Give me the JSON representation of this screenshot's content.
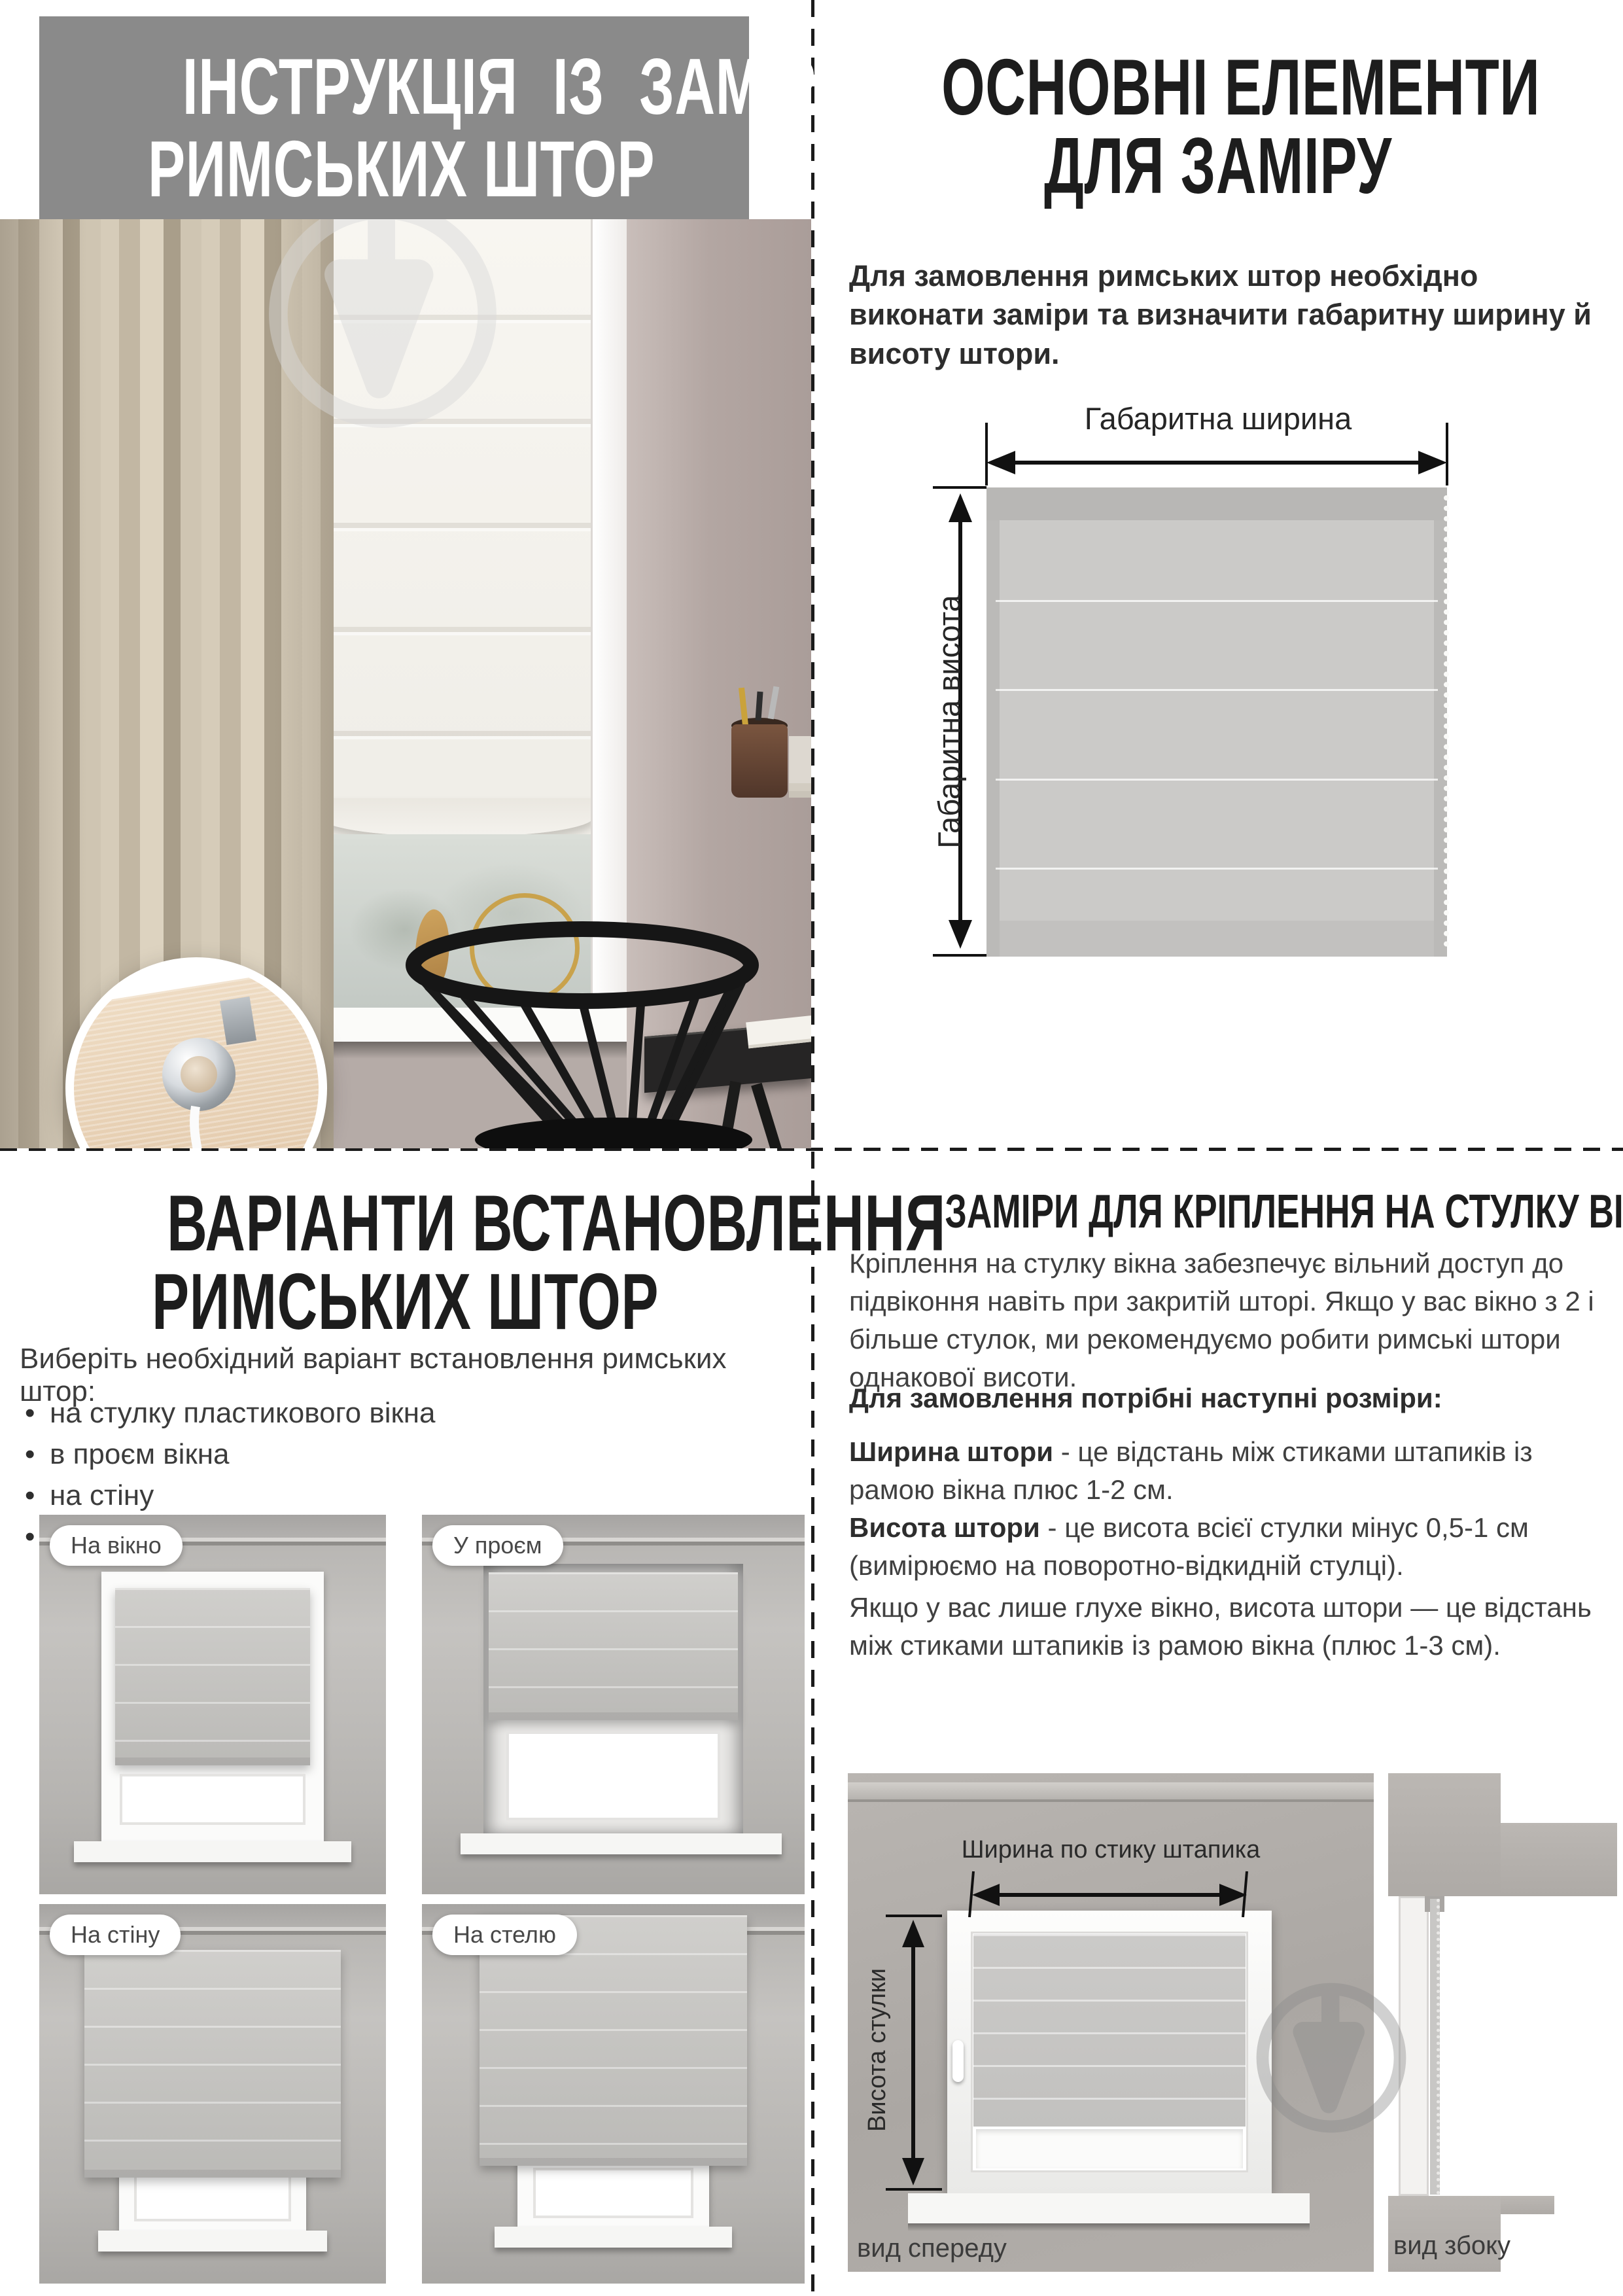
{
  "colors": {
    "header_bg": "#8a8a8a",
    "heading_text": "#1d1d1d",
    "divider": "#1b1b1b",
    "fabric_gray": "#cbcac8",
    "wall_mauve": "#b3a6a2"
  },
  "top_left": {
    "title_line1": "ІНСТРУКЦІЯ ІЗ ЗАМІРУ",
    "title_line2": "РИМСЬКИХ ШТОР"
  },
  "top_right": {
    "title_line1": "ОСНОВНІ ЕЛЕМЕНТИ",
    "title_line2": "ДЛЯ ЗАМІРУ",
    "intro": "Для замовлення римських штор необхідно виконати заміри та визначити габаритну ширину й висоту штори.",
    "diagram": {
      "width_label": "Габаритна ширина",
      "height_label": "Габаритна висота"
    }
  },
  "bottom_left": {
    "title_line1": "ВАРІАНТИ ВСТАНОВЛЕННЯ",
    "title_line2": "РИМСЬКИХ ШТОР",
    "intro": "Виберіть необхідний варіант встановлення римських штор:",
    "options": [
      "на стулку пластикового вікна",
      "в проєм вікна",
      "на стіну",
      "на стелю"
    ],
    "tiles": [
      {
        "label": "На вікно"
      },
      {
        "label": "У проєм"
      },
      {
        "label": "На стіну"
      },
      {
        "label": "На стелю"
      }
    ]
  },
  "bottom_right": {
    "title": "ЗАМІРИ ДЛЯ КРІПЛЕННЯ НА СТУЛКУ ВІКНА",
    "p1": "Кріплення на стулку вікна забезпечує вільний доступ до підвіконня навіть при закритій шторі. Якщо у вас вікно з 2 і більше стулок, ми рекомендуємо робити римські штори однакової висоти.",
    "sizes_lead": "Для замовлення потрібні наступні розміри:",
    "width_term": "Ширина штори",
    "width_def": " - це відстань між стиками штапиків із рамою вікна плюс 1-2 см.",
    "height_term": "Висота штори",
    "height_def": " - це висота всієї стулки мінус 0,5-1 см (вимірюємо на поворотно-відкидній стулці).",
    "p3": "Якщо у вас лише глухе вікно, висота штори — це відстань між стиками штапиків із рамою вікна (плюс 1-3 см).",
    "diagram": {
      "width_label": "Ширина по стику штапика",
      "height_label": "Висота стулки",
      "front_caption": "вид спереду",
      "side_caption": "вид збоку"
    }
  }
}
